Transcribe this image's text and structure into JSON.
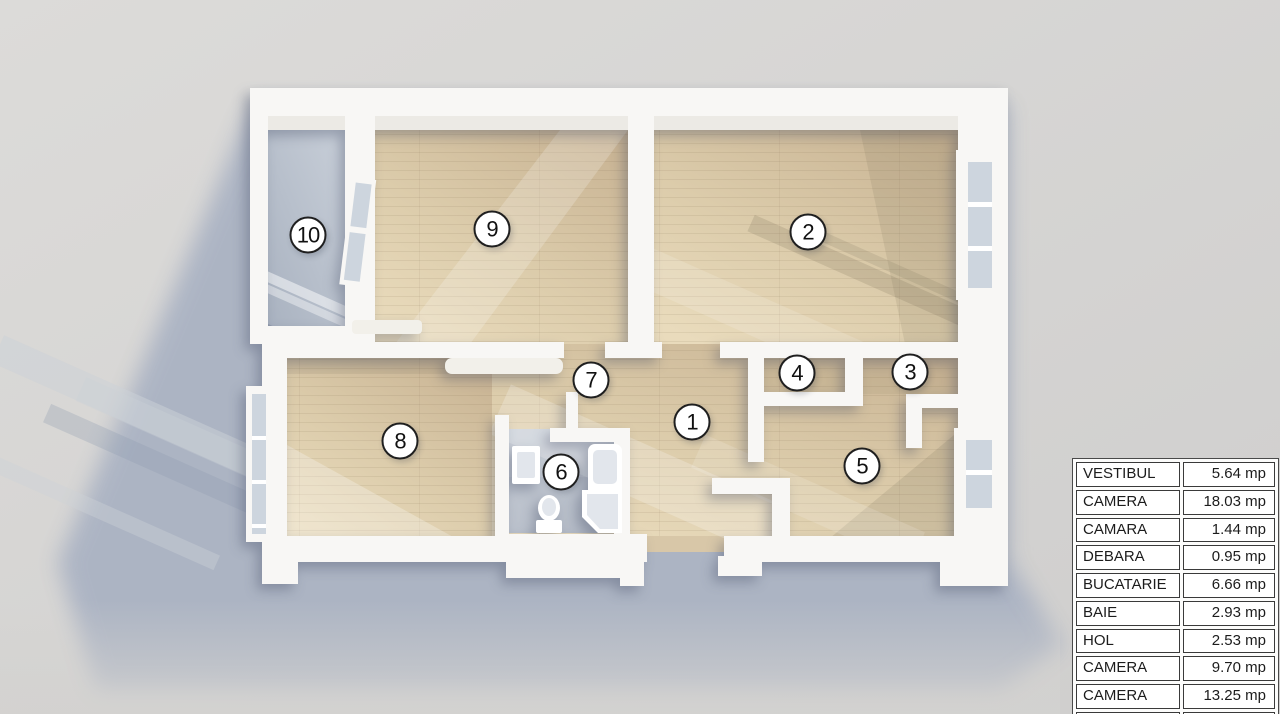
{
  "plan": {
    "unit": "mp",
    "rooms": [
      {
        "number": "1",
        "name": "VESTIBUL",
        "area": "5.64 mp"
      },
      {
        "number": "2",
        "name": "CAMERA",
        "area": "18.03 mp"
      },
      {
        "number": "3",
        "name": "CAMARA",
        "area": "1.44 mp"
      },
      {
        "number": "4",
        "name": "DEBARA",
        "area": "0.95 mp"
      },
      {
        "number": "5",
        "name": "BUCATARIE",
        "area": "6.66 mp"
      },
      {
        "number": "6",
        "name": "BAIE",
        "area": "2.93 mp"
      },
      {
        "number": "7",
        "name": "HOL",
        "area": "2.53 mp"
      },
      {
        "number": "8",
        "name": "CAMERA",
        "area": "9.70 mp"
      },
      {
        "number": "9",
        "name": "CAMERA",
        "area": "13.25 mp"
      },
      {
        "number": "10",
        "name": "BALCON",
        "area": "3.84 mp"
      }
    ]
  },
  "colors": {
    "background": "#d7d6d4",
    "shadow": "#a8b1c2",
    "wall": "#f8f7f5",
    "wood_light": "#e9dbbc",
    "wood_dark": "#c9b494",
    "balcony_light": "#c5ccd6",
    "balcony_dark": "#a9b2c0",
    "bath_floor": "#b9c0cb",
    "glass": "#cdd5de",
    "circle_bg": "#ffffff",
    "circle_border": "#1f1f1f",
    "number_color": "#111111",
    "table_border": "#4a4a4a",
    "cell_border": "#3a3a3a",
    "cell_bg": "#ffffff",
    "text": "#1c1c1c"
  }
}
